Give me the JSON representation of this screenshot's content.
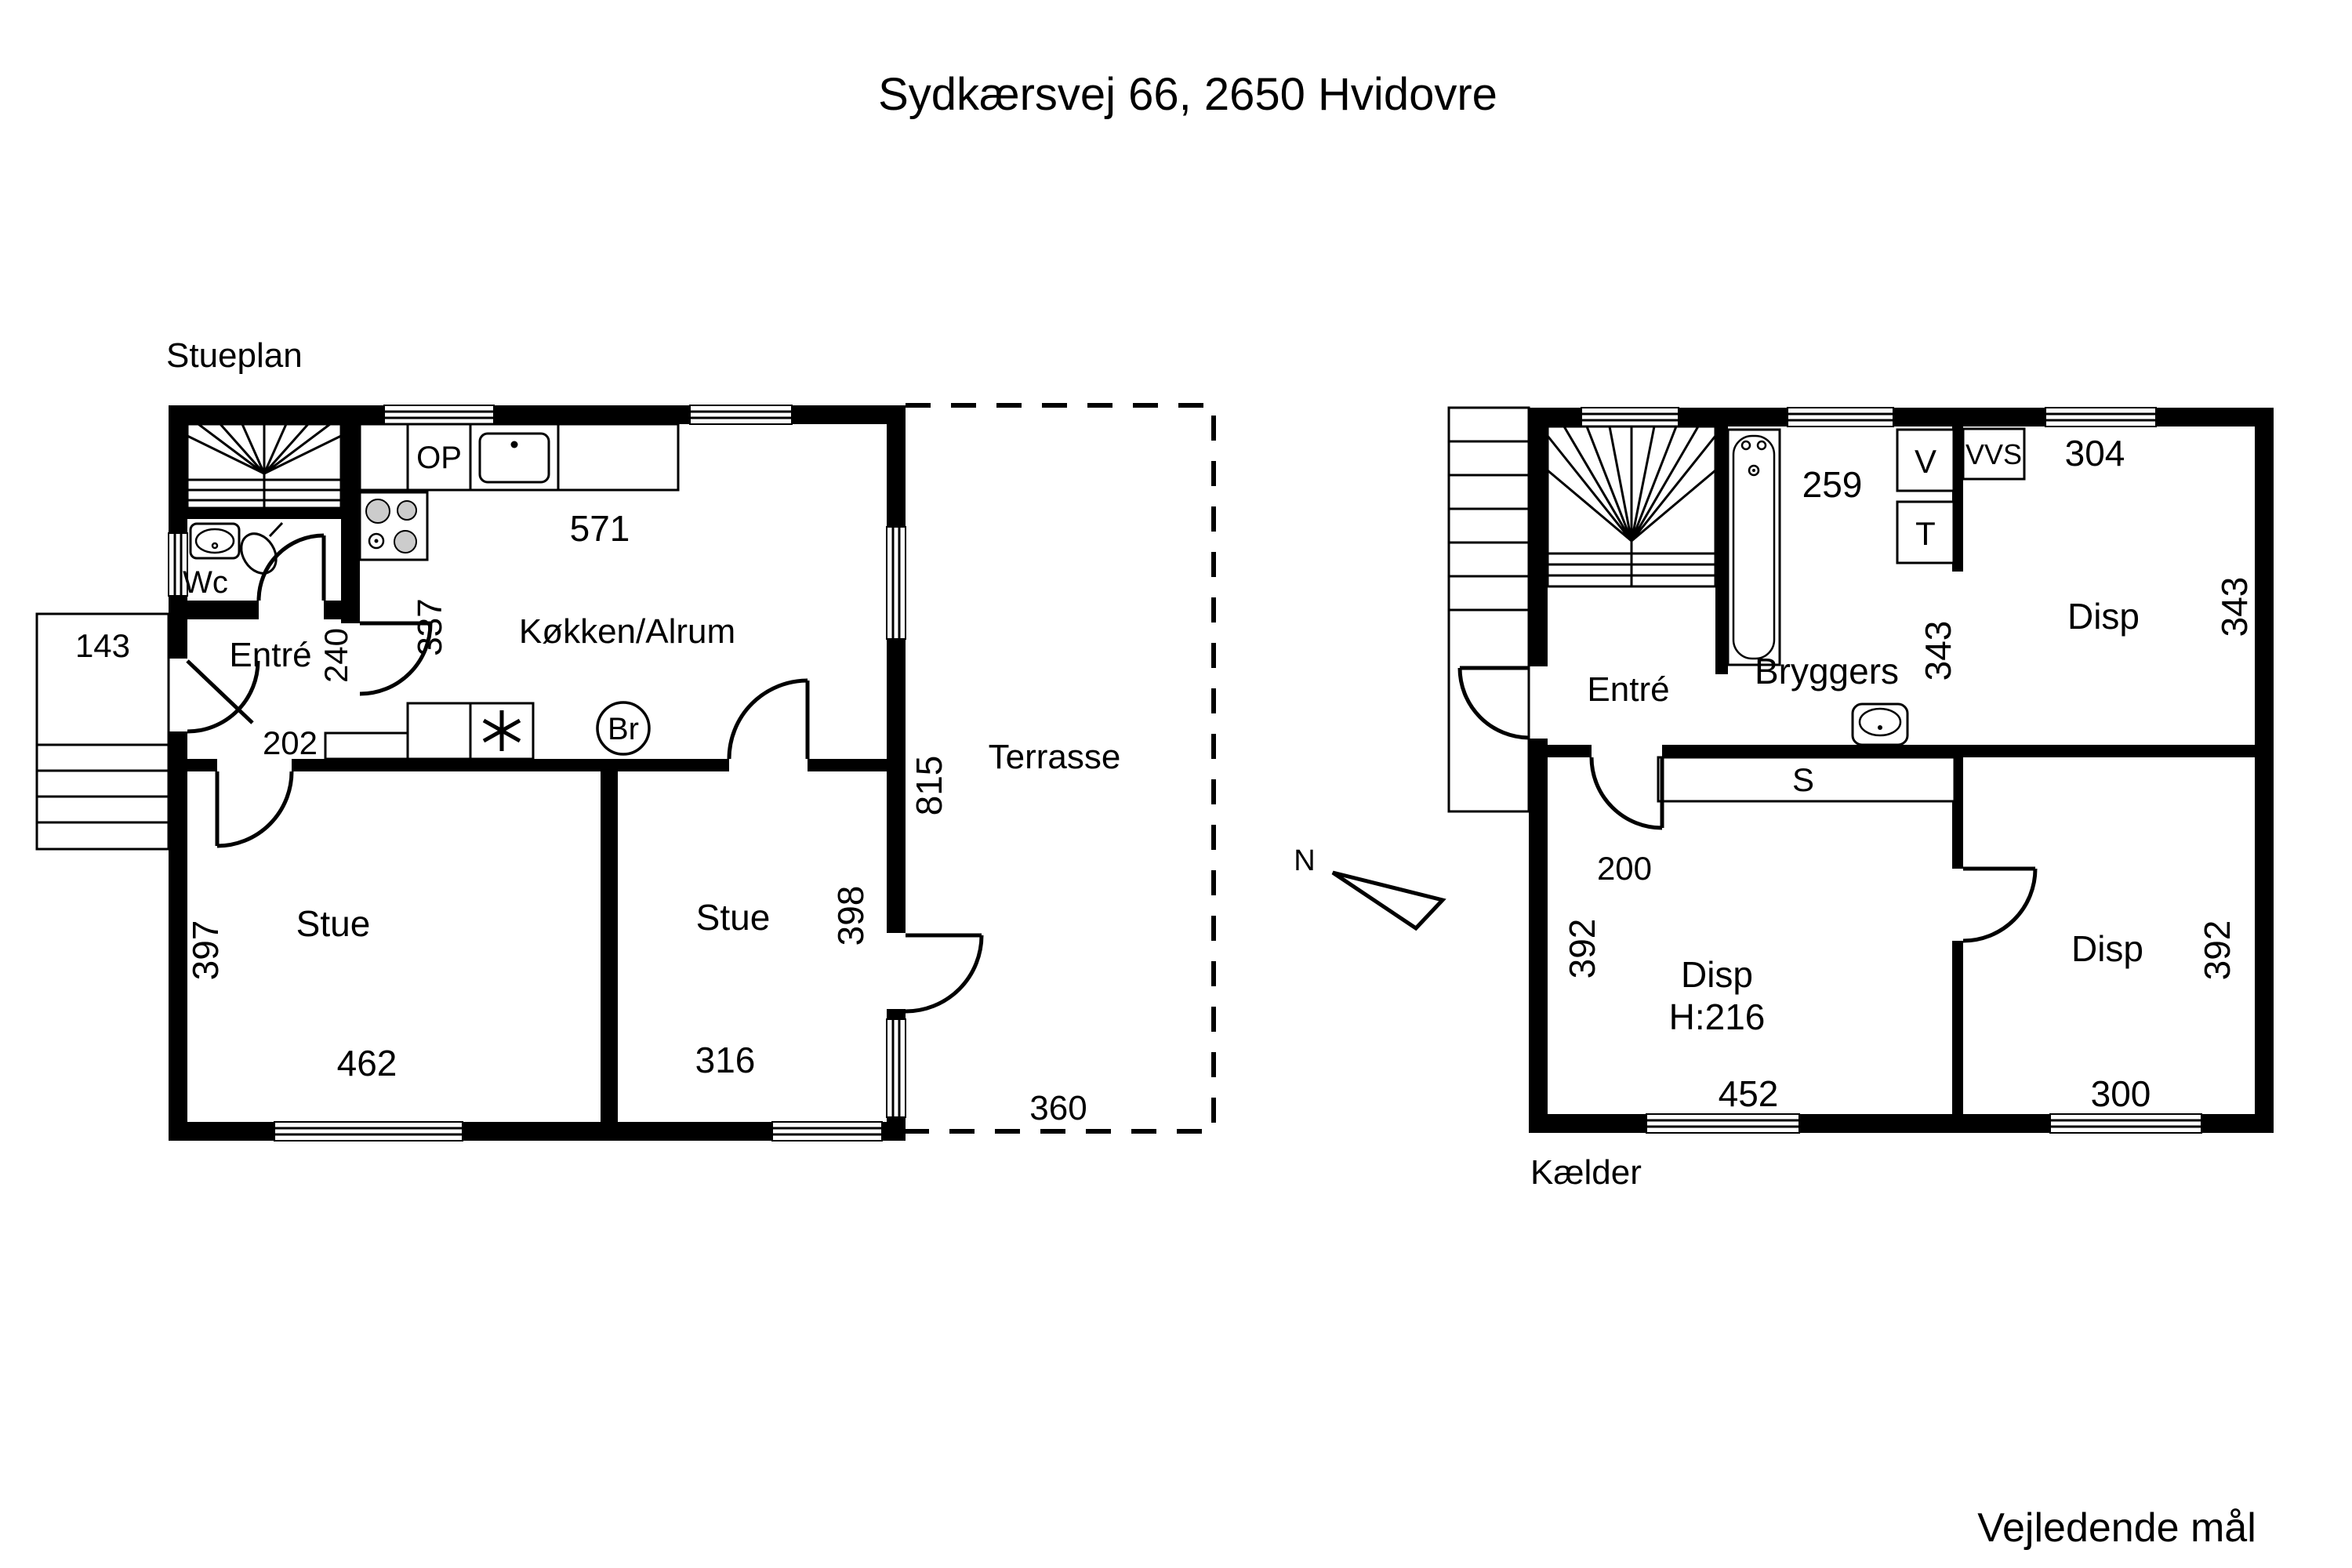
{
  "title": "Sydkærsvej 66, 2650 Hvidovre",
  "footer": "Vejledende mål",
  "compass": {
    "north": "N"
  },
  "stueplan": {
    "label": "Stueplan",
    "rooms": {
      "wc": "Wc",
      "entre": "Entré",
      "kokken": "Køkken/Alrum",
      "stue_left": "Stue",
      "stue_right": "Stue",
      "terrasse": "Terrasse"
    },
    "fixtures": {
      "op": "OP",
      "br": "Br"
    },
    "dims": {
      "landing": "143",
      "entre_width": "202",
      "entre_depth": "240",
      "kokken_depth": "337",
      "kokken_width": "571",
      "stue_left_depth": "397",
      "stue_left_width": "462",
      "stue_right_width": "316",
      "stue_right_depth": "398",
      "terrasse_depth": "815",
      "terrasse_width": "360"
    }
  },
  "kaelder": {
    "label": "Kælder",
    "rooms": {
      "entre": "Entré",
      "bryggers": "Bryggers",
      "disp_top": "Disp",
      "disp_main": "Disp",
      "disp_main_height": "H:216",
      "disp_right": "Disp"
    },
    "fixtures": {
      "v": "V",
      "t": "T",
      "vvs": "VVS",
      "s": "S"
    },
    "dims": {
      "bryggers_width": "259",
      "disp_top_width": "304",
      "bryggers_depth": "343",
      "disp_top_depth": "343",
      "entre_width": "200",
      "disp_main_depth": "392",
      "disp_main_width": "452",
      "disp_right_width": "300",
      "disp_right_depth": "392"
    }
  }
}
